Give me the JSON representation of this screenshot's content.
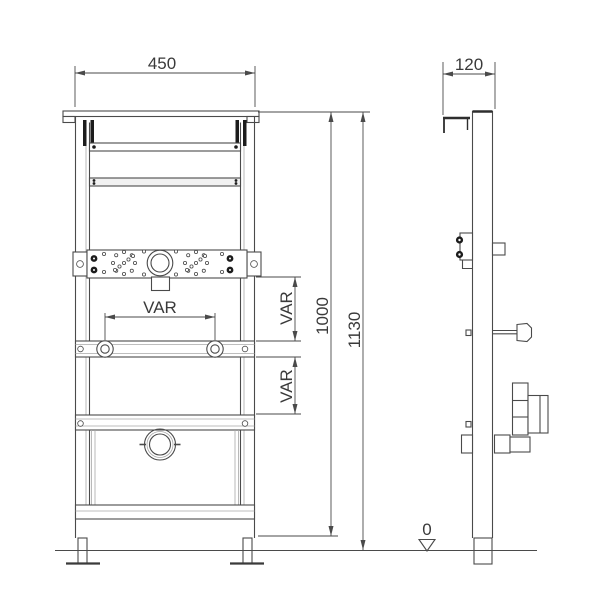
{
  "dims": {
    "front_width": "450",
    "side_depth": "120",
    "var_between_clamps": "VAR",
    "var_upper": "VAR",
    "var_lower": "VAR",
    "frame_height": "1000",
    "total_height": "1130",
    "floor_level": "0"
  },
  "colors": {
    "line": "#4a4a4a",
    "dark_fill": "#1c1c1c",
    "text": "#3a3a3a",
    "light_gray": "#a8a8a8",
    "background": "#ffffff"
  }
}
